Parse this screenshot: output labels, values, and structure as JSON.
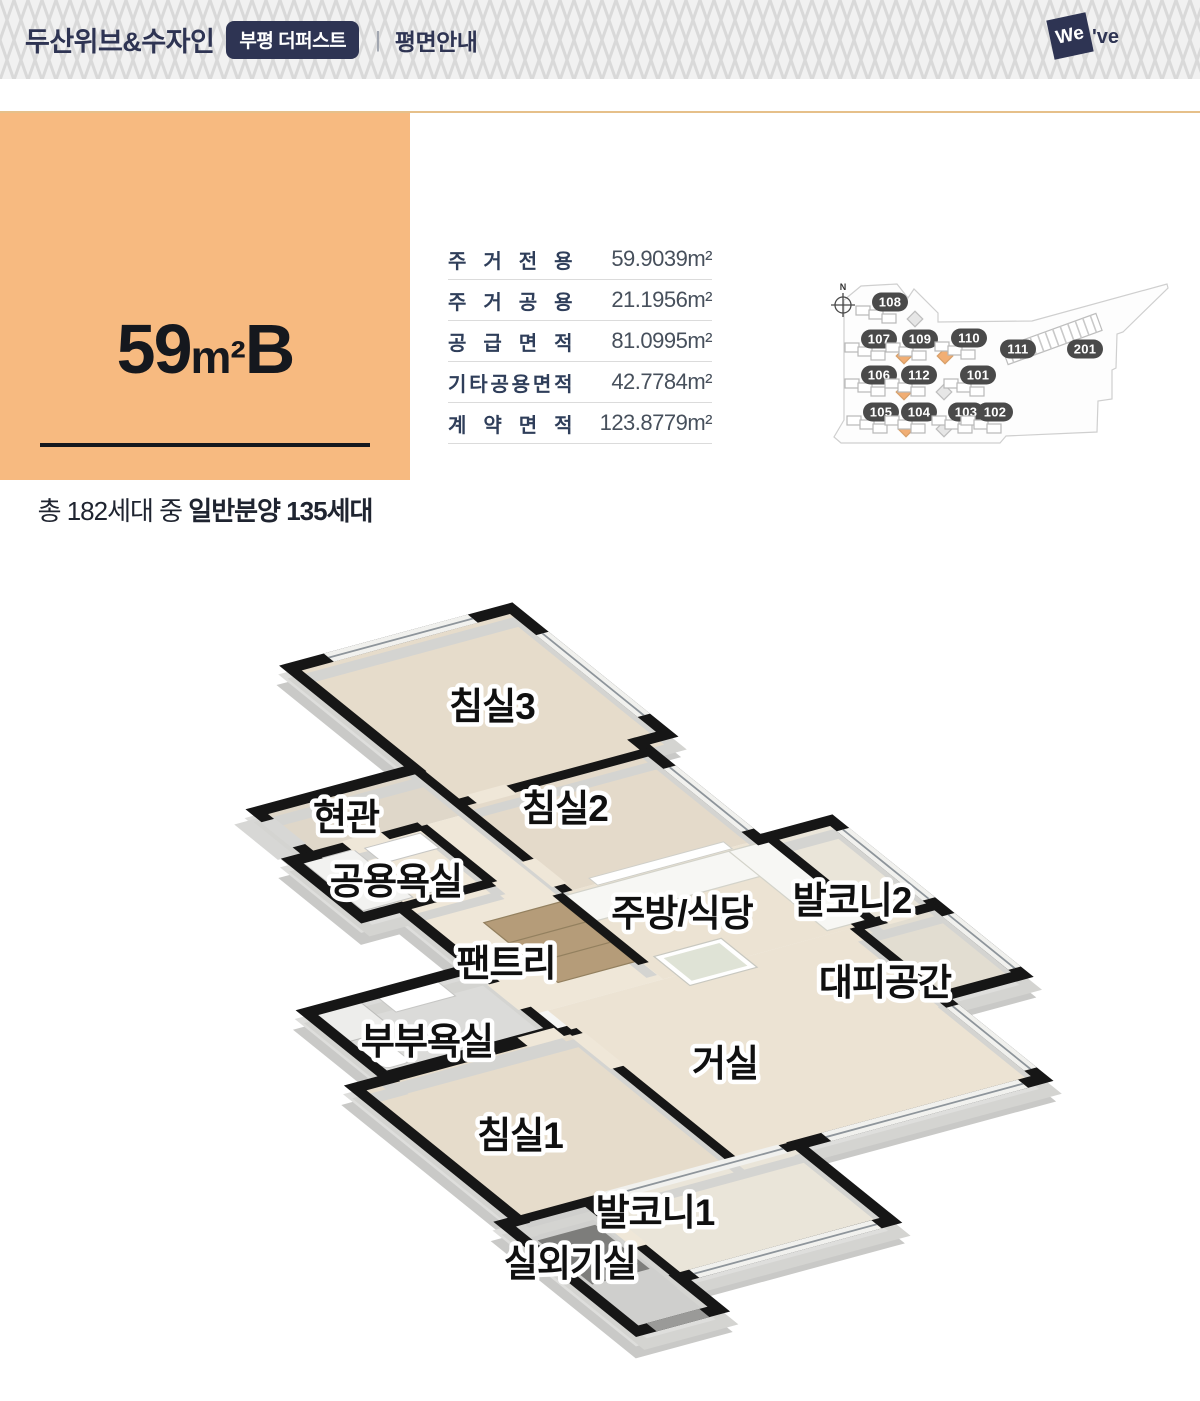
{
  "header": {
    "brand": "두산위브&수자인",
    "badge": "부평 더퍼스트",
    "divider": "|",
    "page_title": "평면안내",
    "logo_square": "We",
    "logo_rest": "'ve"
  },
  "unit_card": {
    "title_number": "59",
    "title_sq": "m²",
    "title_letter": "B",
    "households_prefix": "총 182세대 중 ",
    "households_bold": "일반분양 135세대",
    "bg_color": "#F7BA80"
  },
  "area_table": {
    "rows": [
      {
        "label": "주거전용",
        "value": "59.9039m²"
      },
      {
        "label": "주거공용",
        "value": "21.1956m²"
      },
      {
        "label": "공급면적",
        "value": "81.0995m²"
      },
      {
        "label": "기타공용면적",
        "value": "42.7784m²"
      },
      {
        "label": "계약면적",
        "value": "123.8779m²"
      }
    ]
  },
  "site_plan": {
    "compass_label": "N",
    "highlight_color": "#F1AE74",
    "units": [
      {
        "label": "108",
        "x": 890,
        "y": 302,
        "marker": "gray"
      },
      {
        "label": "107",
        "x": 879,
        "y": 339,
        "marker": "orange"
      },
      {
        "label": "109",
        "x": 920,
        "y": 339,
        "marker": "orange"
      },
      {
        "label": "110",
        "x": 969,
        "y": 338,
        "marker": "none"
      },
      {
        "label": "111",
        "x": 1018,
        "y": 349,
        "marker": "none"
      },
      {
        "label": "201",
        "x": 1085,
        "y": 349,
        "marker": "none"
      },
      {
        "label": "106",
        "x": 879,
        "y": 375,
        "marker": "orange"
      },
      {
        "label": "112",
        "x": 919,
        "y": 375,
        "marker": "gray"
      },
      {
        "label": "101",
        "x": 978,
        "y": 375,
        "marker": "none"
      },
      {
        "label": "105",
        "x": 881,
        "y": 412,
        "marker": "orange"
      },
      {
        "label": "104",
        "x": 919,
        "y": 412,
        "marker": "gray"
      },
      {
        "label": "103",
        "x": 966,
        "y": 412,
        "marker": "none"
      },
      {
        "label": "102",
        "x": 995,
        "y": 412,
        "marker": "none"
      }
    ]
  },
  "floor_plan": {
    "rooms": [
      {
        "label": "침실3",
        "x": 492,
        "y": 706
      },
      {
        "label": "현관",
        "x": 346,
        "y": 817
      },
      {
        "label": "침실2",
        "x": 565,
        "y": 808
      },
      {
        "label": "공용욕실",
        "x": 396,
        "y": 881
      },
      {
        "label": "주방/식당",
        "x": 682,
        "y": 913
      },
      {
        "label": "발코니2",
        "x": 852,
        "y": 900
      },
      {
        "label": "팬트리",
        "x": 506,
        "y": 963
      },
      {
        "label": "대피공간",
        "x": 885,
        "y": 982
      },
      {
        "label": "부부욕실",
        "x": 427,
        "y": 1041
      },
      {
        "label": "거실",
        "x": 725,
        "y": 1063
      },
      {
        "label": "침실1",
        "x": 520,
        "y": 1135
      },
      {
        "label": "발코니1",
        "x": 655,
        "y": 1212
      },
      {
        "label": "실외기실",
        "x": 570,
        "y": 1263
      }
    ]
  }
}
